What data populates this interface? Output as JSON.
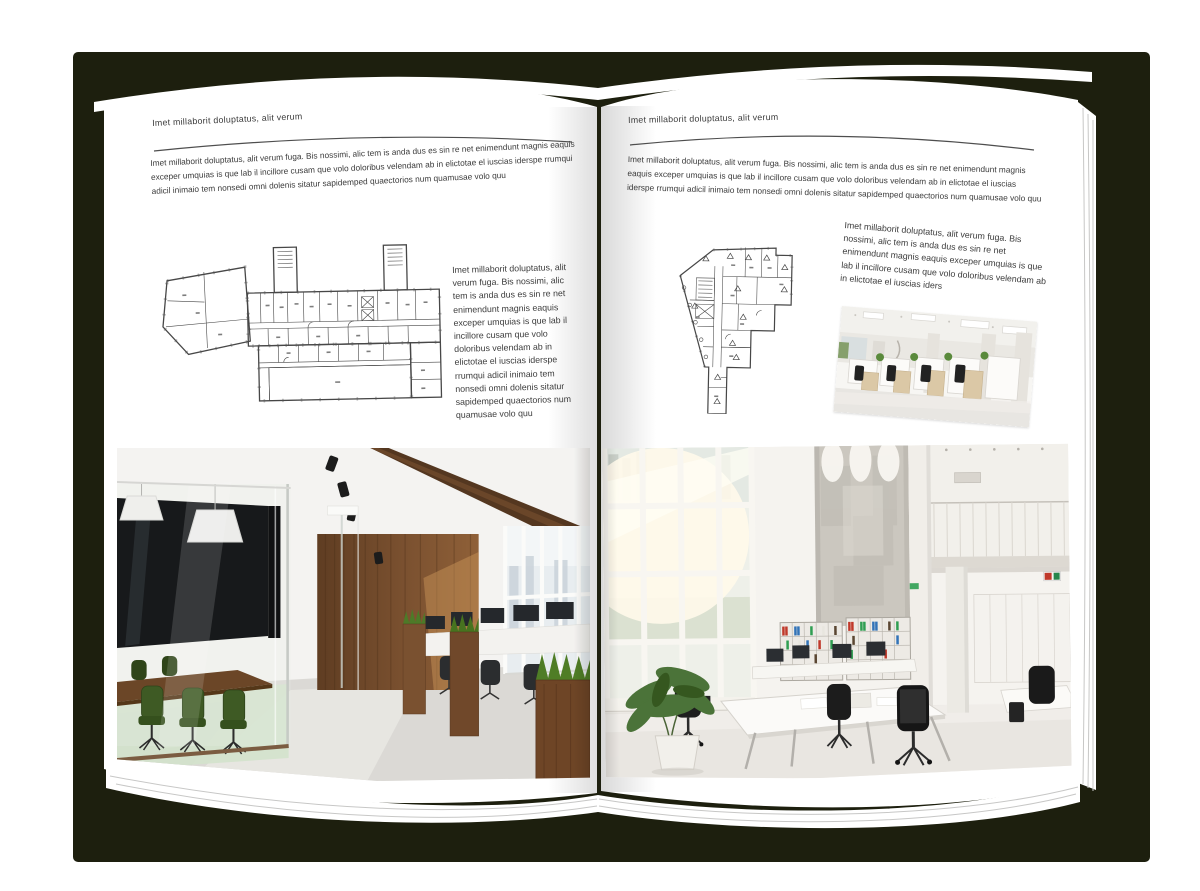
{
  "palette": {
    "backdrop": "#1d1f0e",
    "page": "#ffffff",
    "text": "#3a3a3a",
    "rule": "#4e4e4e",
    "plan_line": "#474747",
    "wood": "#7b5130",
    "plant_green": "#4e7c28"
  },
  "left_page": {
    "header": "Imet millaborit doluptatus, alit verum",
    "intro": "Imet millaborit doluptatus, alit verum fuga. Bis nossimi, alic tem is anda dus es sin re net enimendunt magnis eaquis exceper umquias is que lab il incillore cusam que volo doloribus velendam ab in elictotae el iuscias iderspe rrumqui adicil inimaio tem nonsedi omni dolenis sitatur sapidemped quaectorios num quamusae volo quu",
    "side_text": "Imet millaborit doluptatus, alit verum fuga. Bis nossimi, alic tem is anda dus es sin re net enimendunt magnis eaquis exceper umquias is que lab il incillore cusam que volo doloribus velendam ab in elictotae el iuscias iderspe rrumqui adicil inimaio tem nonsedi omni dolenis sitatur sapidemped quaectorios num quamusae volo quu"
  },
  "right_page": {
    "header": "Imet millaborit doluptatus, alit verum",
    "intro": "Imet millaborit doluptatus, alit verum fuga. Bis nossimi, alic tem is anda dus es sin re net enimendunt magnis eaquis exceper umquias is que lab il incillore cusam que volo doloribus velendam ab in elictotae el iuscias iderspe rrumqui adicil inimaio tem nonsedi omni dolenis sitatur sapidemped quaectorios num quamusae volo quu",
    "side_text": "Imet millaborit doluptatus, alit verum fuga. Bis nossimi, alic tem is anda dus es sin re net enimendunt magnis eaquis exceper umquias is que lab il incillore cusam que volo doloribus velendam ab in elictotae el iuscias iders"
  }
}
